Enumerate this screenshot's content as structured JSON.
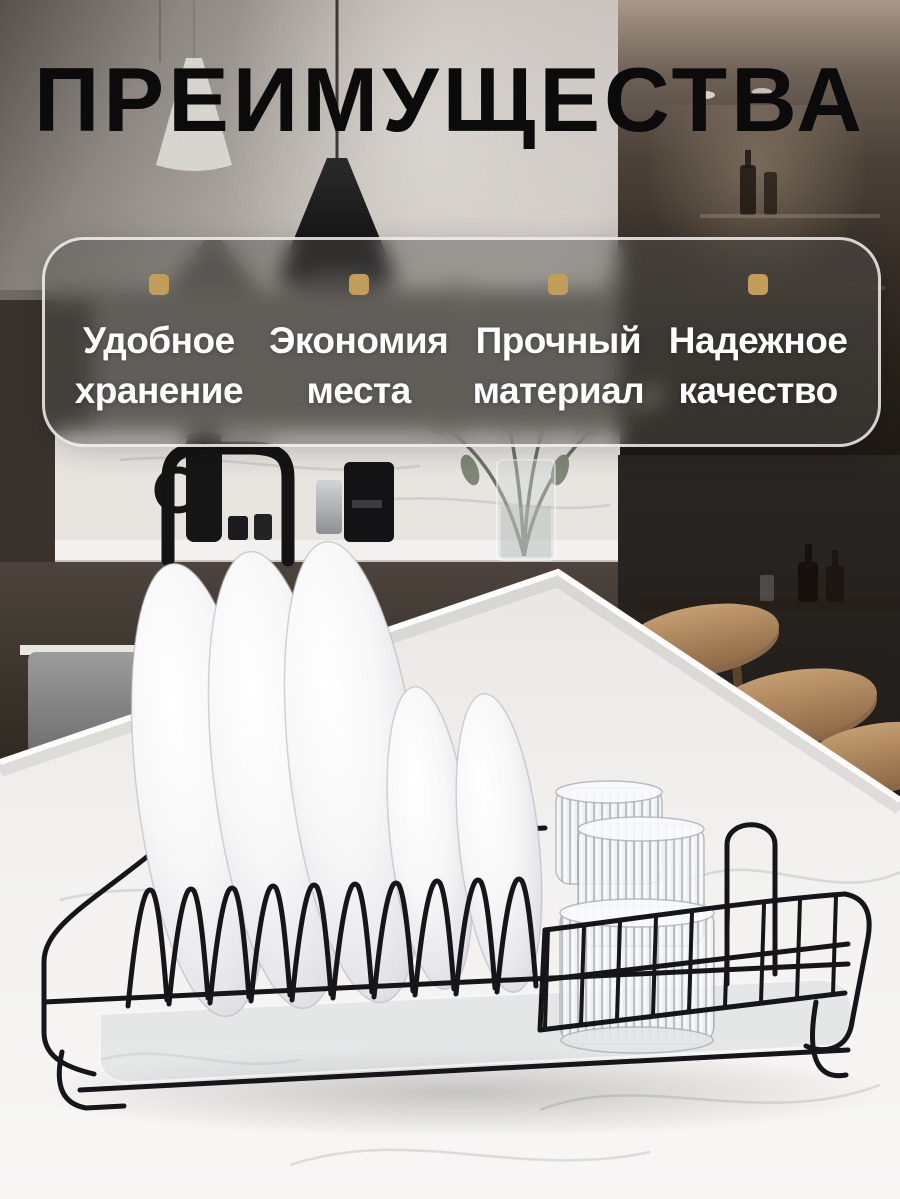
{
  "header": {
    "title": "ПРЕИМУЩЕСТВА"
  },
  "advantages": {
    "items": [
      {
        "bullet_icon": "gold-square",
        "line1": "Удобное",
        "line2": "хранение"
      },
      {
        "bullet_icon": "gold-square",
        "line1": "Экономия",
        "line2": "места"
      },
      {
        "bullet_icon": "gold-square",
        "line1": "Прочный",
        "line2": "материал"
      },
      {
        "bullet_icon": "gold-square",
        "line1": "Надежное",
        "line2": "качество"
      }
    ]
  },
  "colors": {
    "accent_gold": "#C49C59",
    "title_text": "#0B0B0B",
    "feature_text": "#FFFFFF",
    "rack_wire": "#15151A"
  }
}
